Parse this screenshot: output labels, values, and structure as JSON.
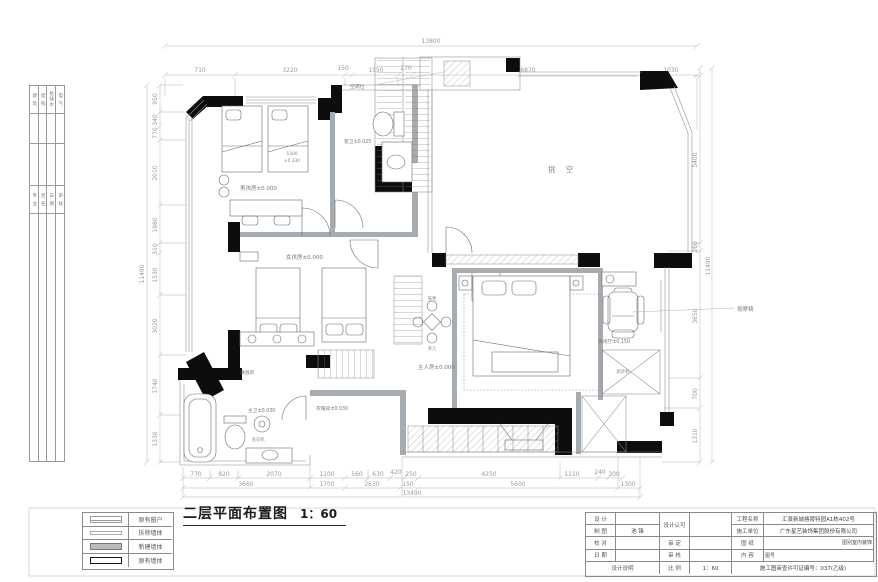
{
  "sheet": {
    "strip_top": [
      "建 筑",
      "结 构",
      "给排水",
      "电 气"
    ],
    "strip_mid": [
      "专 业",
      "签 名",
      "日 期",
      "审 核"
    ],
    "legend": [
      {
        "label": "原有窗户"
      },
      {
        "label": "拆除墙体"
      },
      {
        "label": "新建墙体"
      },
      {
        "label": "原有墙体"
      }
    ],
    "title": "二层平面布置图",
    "scale": "1：60"
  },
  "title_block": {
    "design_label": "设 计",
    "design_value": "",
    "draft_label": "制 图",
    "draft_value": "池 锋",
    "check_label": "校 对",
    "check_value": "",
    "date_label": "日 期",
    "date_value": "",
    "notes_label": "设计说明",
    "approve_label": "设计认可",
    "approve_value": "",
    "review_label": "审 定",
    "review_value": "",
    "audit_label": "审 核",
    "audit_value": "",
    "scale_label": "比 例",
    "scale_value": "1：60",
    "project_label": "工程名称",
    "project_value": "汇景新城格陵特园A1栋402号",
    "contractor_label": "施工单位",
    "contractor_value": "广东星艺装饰集团股份有限公司",
    "sheet_label": "图 纸",
    "content_label": "内 容",
    "category_label": "图别",
    "category_value": "室内装饰",
    "sheet_no_label": "图号",
    "permit": "施工图审查许可证编号：037(乙级)"
  },
  "dims": {
    "top": {
      "total": "13800",
      "segs": [
        "710",
        "3220",
        "150",
        "1550",
        "270",
        "6870",
        "1030"
      ]
    },
    "left": {
      "total": "11490",
      "segs": [
        "950",
        "340",
        "770",
        "2010",
        "1980",
        "310",
        "1530",
        "3020",
        "1740",
        "1330"
      ]
    },
    "right": {
      "total": "11490",
      "segs": [
        "5400",
        "260",
        "3650",
        "700",
        "1310"
      ]
    },
    "bottom": {
      "total": "13490",
      "row1": [
        "770",
        "820",
        "2070",
        "1100",
        "560",
        "630",
        "420",
        "250",
        "4250",
        "1110",
        "240",
        "300"
      ],
      "row2": [
        "3660",
        "1700",
        "2630",
        "150",
        "5600",
        "1300"
      ]
    }
  },
  "labels": {
    "boy_room": "男孩房±0.000",
    "boy_bed_w": "1300",
    "boy_bed_lvl": "±0.330",
    "bath_top": "客卫±0.025",
    "ac_platform": "空调位",
    "void": "挑 空",
    "girl_room": "女孩房±0.000",
    "master_room": "主人房±0.000",
    "stool": "鼓凳",
    "tea_table": "茶几",
    "leisure": "休闲厅±0.150",
    "massage_chair": "按摩椅",
    "treadmill": "跑步机",
    "shower": "淋浴房",
    "master_bath": "主卫±0.030",
    "washer": "洗衣机",
    "cloakroom": "衣帽间±0.030"
  }
}
